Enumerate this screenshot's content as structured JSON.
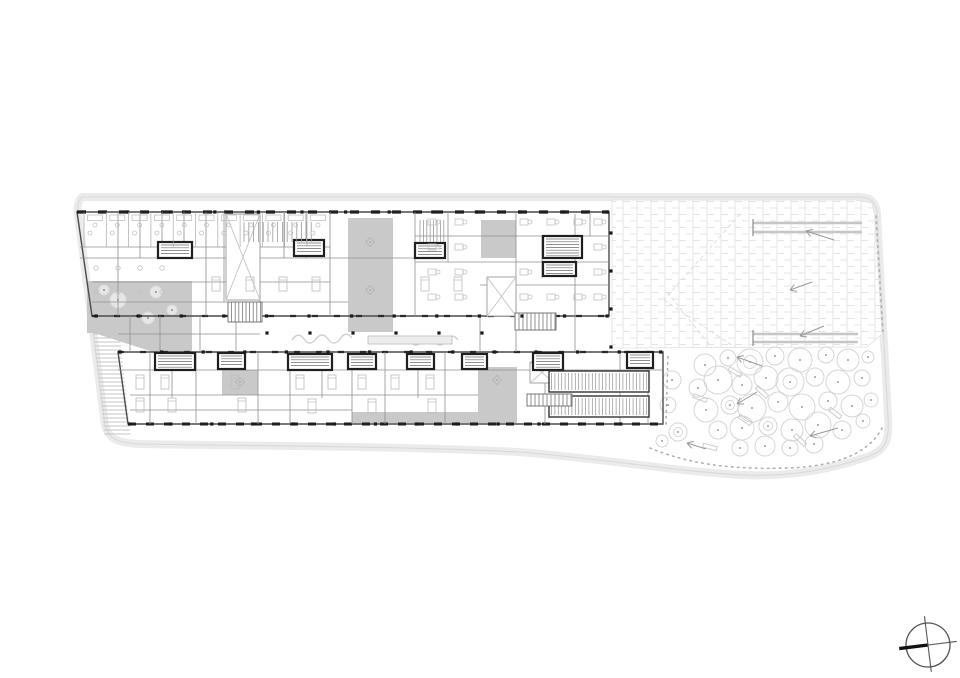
{
  "meta": {
    "description": "architectural ground floor plan drawing, no visible text",
    "compass_icon": "north-compass-icon"
  },
  "colors": {
    "paper": "#ffffff",
    "site_band": "#ebebeb",
    "site_edge": "#d9d9d9",
    "wall_dark": "#1f1f1f",
    "wall_mid": "#555555",
    "wall_light": "#8f8f8f",
    "furniture": "#c2c2c2",
    "courtyard": "#c9c9c9",
    "walkway": "#cfcfcf",
    "brick": "#e4e4e4",
    "tree": "#d5d5d5",
    "tree_dot": "#9a9a9a",
    "stair": "#c6c6c6",
    "arrow": "#9a9a9a",
    "dots": "#b0b0b0",
    "void_x": "#c9c9c9"
  },
  "canvas": {
    "w": 960,
    "h": 678
  },
  "site": {
    "outline": "M 82,197 H 858 C 871,197 876,202 877,214 L 888,418 C 890,444 883,451 867,457 C 829,470 787,477 744,475 C 679,472 599,458 519,452 C 399,446 250,446 140,444 C 112,443 106,436 104,418 L 78,214 C 76,202 82,197 82,197 Z"
  },
  "plaza": {
    "poly": "612,200 856,200 872,203 875,216 882,334 867,347 612,348",
    "brick_w": 7,
    "brick_h": 13,
    "benches": [
      [
        753,
        223,
        862,
        223
      ],
      [
        753,
        232,
        862,
        232
      ],
      [
        753,
        334,
        858,
        334
      ],
      [
        753,
        342,
        858,
        342
      ]
    ],
    "bench_ticks": [
      [
        753,
        219,
        753,
        236
      ],
      [
        753,
        330,
        753,
        346
      ]
    ],
    "sightlines": [
      [
        740,
        214,
        664,
        300
      ],
      [
        664,
        300,
        736,
        348
      ],
      [
        667,
        292,
        712,
        348
      ]
    ],
    "arrows": [
      [
        834,
        240,
        806,
        231
      ],
      [
        812,
        282,
        790,
        290
      ],
      [
        824,
        326,
        800,
        336
      ]
    ],
    "dotted_edge": "M 876,216 L 883,334"
  },
  "garden": {
    "poly": "668,352 870,348 881,352 884,424 873,444 845,456 788,468 726,468 680,458 650,448 666,424",
    "dotted_edge": "M 666,424 L 668,353 M 650,448 C 684,462 724,470 788,468 C 840,466 872,452 884,424",
    "trees": [
      [
        672,
        380,
        9,
        0
      ],
      [
        668,
        405,
        8,
        0
      ],
      [
        678,
        432,
        9,
        1
      ],
      [
        662,
        441,
        6,
        0
      ],
      [
        705,
        365,
        11,
        0
      ],
      [
        728,
        358,
        8,
        0
      ],
      [
        750,
        362,
        13,
        1
      ],
      [
        775,
        356,
        9,
        0
      ],
      [
        800,
        360,
        12,
        0
      ],
      [
        826,
        355,
        8,
        0
      ],
      [
        848,
        360,
        11,
        0
      ],
      [
        868,
        357,
        6,
        0
      ],
      [
        698,
        388,
        9,
        0
      ],
      [
        718,
        380,
        14,
        0
      ],
      [
        742,
        385,
        10,
        0
      ],
      [
        766,
        378,
        12,
        0
      ],
      [
        790,
        382,
        14,
        1
      ],
      [
        815,
        377,
        9,
        0
      ],
      [
        838,
        382,
        12,
        0
      ],
      [
        862,
        378,
        8,
        0
      ],
      [
        706,
        410,
        12,
        0
      ],
      [
        730,
        405,
        9,
        1
      ],
      [
        752,
        408,
        14,
        0
      ],
      [
        778,
        402,
        10,
        0
      ],
      [
        802,
        407,
        13,
        0
      ],
      [
        828,
        401,
        9,
        0
      ],
      [
        852,
        406,
        11,
        0
      ],
      [
        871,
        400,
        7,
        0
      ],
      [
        718,
        430,
        9,
        0
      ],
      [
        742,
        428,
        12,
        0
      ],
      [
        768,
        426,
        9,
        1
      ],
      [
        792,
        430,
        11,
        0
      ],
      [
        818,
        425,
        13,
        0
      ],
      [
        842,
        430,
        9,
        0
      ],
      [
        863,
        421,
        7,
        0
      ],
      [
        740,
        448,
        8,
        0
      ],
      [
        765,
        446,
        10,
        0
      ],
      [
        790,
        448,
        8,
        0
      ],
      [
        814,
        444,
        9,
        0
      ]
    ],
    "benches": [
      [
        735,
        372,
        30
      ],
      [
        762,
        392,
        42
      ],
      [
        700,
        398,
        20
      ],
      [
        745,
        420,
        35
      ],
      [
        800,
        440,
        42
      ],
      [
        710,
        447,
        15
      ],
      [
        835,
        413,
        38
      ]
    ],
    "arrows": [
      [
        762,
        366,
        737,
        357
      ],
      [
        757,
        392,
        737,
        404
      ],
      [
        838,
        428,
        810,
        436
      ],
      [
        706,
        449,
        687,
        443
      ]
    ]
  },
  "building": {
    "north_wing": "77,212 609,212 609,316 92,316",
    "south_wing": "118,352 663,352 663,424 128,424",
    "ext_walls": [
      {
        "x1": 77,
        "y1": 212,
        "x2": 609,
        "y2": 212,
        "w": 3.2,
        "dash": "9 12",
        "c": "#1f1f1f"
      },
      {
        "x1": 92,
        "y1": 316,
        "x2": 609,
        "y2": 316,
        "w": 2.2,
        "dash": "6 16",
        "c": "#2a2a2a"
      },
      {
        "x1": 118,
        "y1": 352,
        "x2": 663,
        "y2": 352,
        "w": 2.2,
        "dash": "6 16",
        "c": "#2a2a2a"
      },
      {
        "x1": 128,
        "y1": 424,
        "x2": 663,
        "y2": 424,
        "w": 3.0,
        "dash": "8 10",
        "c": "#1f1f1f"
      }
    ],
    "walls_v": [
      [
        118,
        212,
        316
      ],
      [
        140,
        212,
        258
      ],
      [
        162,
        212,
        258
      ],
      [
        184,
        212,
        258
      ],
      [
        206,
        212,
        316
      ],
      [
        224,
        212,
        302
      ],
      [
        260,
        212,
        302
      ],
      [
        284,
        212,
        258
      ],
      [
        306,
        212,
        258
      ],
      [
        330,
        212,
        316
      ],
      [
        415,
        212,
        316
      ],
      [
        448,
        212,
        262
      ],
      [
        516,
        212,
        316
      ],
      [
        542,
        236,
        278
      ],
      [
        575,
        214,
        316
      ],
      [
        590,
        212,
        236
      ],
      [
        130,
        316,
        352
      ],
      [
        160,
        316,
        352
      ],
      [
        200,
        316,
        352
      ],
      [
        236,
        316,
        352
      ],
      [
        480,
        316,
        352
      ],
      [
        516,
        316,
        352
      ],
      [
        575,
        316,
        352
      ],
      [
        150,
        352,
        424
      ],
      [
        172,
        352,
        398
      ],
      [
        196,
        352,
        424
      ],
      [
        222,
        352,
        370
      ],
      [
        258,
        352,
        424
      ],
      [
        290,
        370,
        424
      ],
      [
        322,
        352,
        398
      ],
      [
        352,
        352,
        424
      ],
      [
        385,
        352,
        424
      ],
      [
        418,
        352,
        398
      ],
      [
        445,
        352,
        424
      ],
      [
        545,
        352,
        424
      ],
      [
        620,
        352,
        424
      ],
      [
        648,
        352,
        424
      ]
    ],
    "walls_h": [
      [
        247,
        80,
        330
      ],
      [
        258,
        80,
        420
      ],
      [
        282,
        92,
        330
      ],
      [
        302,
        92,
        348
      ],
      [
        236,
        415,
        609
      ],
      [
        262,
        415,
        609
      ],
      [
        285,
        480,
        609
      ],
      [
        334,
        118,
        260
      ],
      [
        370,
        118,
        663
      ],
      [
        395,
        130,
        478
      ],
      [
        410,
        130,
        352
      ]
    ],
    "courtyards": [
      {
        "poly": "87,281 192,281 192,352 153,352 94,333 87,333"
      },
      {
        "rect": [
          348,
          218,
          45,
          114
        ]
      },
      {
        "rect": [
          481,
          220,
          35,
          38
        ]
      },
      {
        "rect": [
          222,
          370,
          36,
          25
        ]
      },
      {
        "rect": [
          478,
          367,
          39,
          56
        ]
      },
      {
        "rect": [
          352,
          412,
          126,
          11
        ]
      }
    ],
    "court_trees": [
      [
        118,
        300,
        8
      ],
      [
        156,
        292,
        6
      ],
      [
        148,
        318,
        6
      ],
      [
        172,
        310,
        5
      ],
      [
        104,
        290,
        5
      ]
    ],
    "diamonds": [
      [
        370,
        242
      ],
      [
        370,
        290
      ],
      [
        240,
        382
      ],
      [
        497,
        380
      ]
    ],
    "voids": [
      [
        226,
        214,
        34,
        86
      ],
      [
        487,
        277,
        29,
        39
      ],
      [
        530,
        362,
        24,
        21
      ]
    ],
    "dark_rooms": [
      [
        158,
        242,
        34,
        16
      ],
      [
        294,
        240,
        30,
        16
      ],
      [
        415,
        243,
        30,
        15
      ],
      [
        543,
        236,
        39,
        22
      ],
      [
        543,
        262,
        33,
        14
      ],
      [
        155,
        353,
        40,
        17
      ],
      [
        218,
        353,
        27,
        16
      ],
      [
        288,
        354,
        44,
        16
      ],
      [
        348,
        354,
        28,
        15
      ],
      [
        407,
        354,
        27,
        15
      ],
      [
        462,
        354,
        25,
        15
      ],
      [
        533,
        353,
        30,
        17
      ],
      [
        627,
        352,
        26,
        16
      ]
    ],
    "hatch_rooms": [
      [
        549,
        371,
        100,
        21
      ],
      [
        549,
        396,
        100,
        21
      ]
    ],
    "seat_rows": [
      [
        244,
        222,
        68,
        20,
        4.8
      ],
      [
        420,
        220,
        26,
        22,
        3.4
      ]
    ],
    "stairs": [
      [
        228,
        302,
        34,
        20,
        3.6
      ],
      [
        515,
        313,
        41,
        17,
        4
      ],
      [
        527,
        394,
        45,
        12,
        4
      ]
    ],
    "ext_stair": {
      "x": 92,
      "y0": 318,
      "y1": 434,
      "wd": 26,
      "step": 4,
      "slope": 0.107
    },
    "columns": {
      "size": 3.2,
      "rows": [
        {
          "y": 212,
          "x0": 84,
          "x1": 608,
          "step": 43.6
        },
        {
          "y": 316,
          "x0": 96,
          "x1": 608,
          "step": 42.6
        },
        {
          "y": 352,
          "x0": 120,
          "x1": 661,
          "step": 41.6
        },
        {
          "y": 424,
          "x0": 130,
          "x1": 661,
          "step": 40.9
        },
        {
          "y": 333,
          "x0": 267,
          "x1": 482,
          "step": 43
        }
      ],
      "cols": [
        {
          "x": 611,
          "y0": 233,
          "y1": 348,
          "step": 38
        }
      ]
    }
  },
  "furniture": {
    "top_offices": {
      "x0": 84,
      "count": 11,
      "step": 22.3,
      "y": 212
    },
    "desks": [
      [
        432,
        222
      ],
      [
        459,
        222
      ],
      [
        524,
        222
      ],
      [
        551,
        222
      ],
      [
        578,
        222
      ],
      [
        598,
        222
      ],
      [
        432,
        247
      ],
      [
        459,
        247
      ],
      [
        598,
        247
      ],
      [
        432,
        272
      ],
      [
        459,
        272
      ],
      [
        524,
        272
      ],
      [
        598,
        272
      ],
      [
        432,
        297
      ],
      [
        459,
        297
      ],
      [
        524,
        297
      ],
      [
        551,
        297
      ],
      [
        578,
        297
      ],
      [
        598,
        297
      ]
    ],
    "beds": [
      [
        216,
        284
      ],
      [
        250,
        284
      ],
      [
        283,
        284
      ],
      [
        316,
        284
      ],
      [
        425,
        284
      ],
      [
        458,
        284
      ],
      [
        140,
        382
      ],
      [
        165,
        382
      ],
      [
        235,
        382
      ],
      [
        300,
        382
      ],
      [
        332,
        382
      ],
      [
        362,
        382
      ],
      [
        395,
        382
      ],
      [
        430,
        382
      ],
      [
        140,
        405
      ],
      [
        172,
        405
      ],
      [
        242,
        405
      ],
      [
        312,
        406
      ],
      [
        372,
        406
      ],
      [
        432,
        406
      ]
    ],
    "chairs": [
      [
        96,
        268
      ],
      [
        118,
        268
      ],
      [
        140,
        268
      ],
      [
        162,
        268
      ],
      [
        96,
        292
      ],
      [
        118,
        292
      ],
      [
        140,
        292
      ],
      [
        162,
        292
      ]
    ],
    "sofas": [
      "M292,340 q6,-9 12,-1 q6,8 12,0 q6,-8 12,0 q6,8 12,0 q6,-9 12,-1",
      "M398,342 q6,-9 12,-1 q6,8 12,0 q6,-8 12,0 q6,8 12,0 q6,-9 12,-1"
    ],
    "counter": [
      368,
      336,
      84,
      8
    ]
  },
  "compass": {
    "cx": 928,
    "cy": 645,
    "r": 22,
    "angle": -7
  }
}
